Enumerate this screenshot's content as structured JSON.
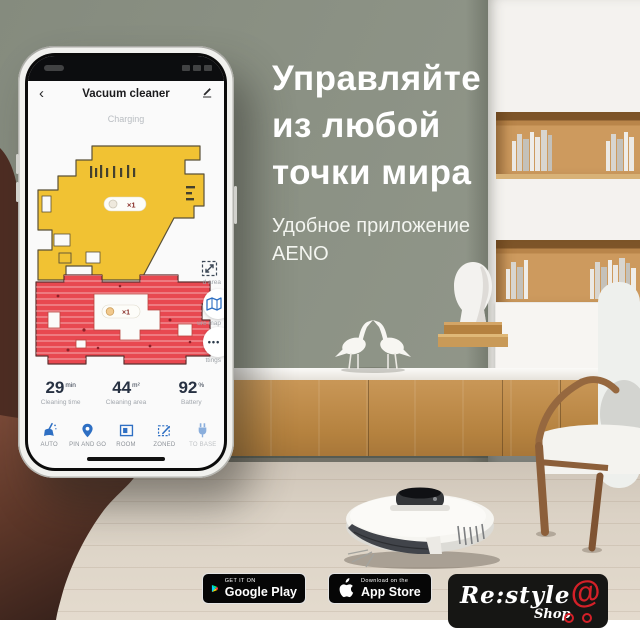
{
  "hero": {
    "title_line1": "Управляйте",
    "title_line2": "из любой",
    "title_line3": "точки мира",
    "subtitle": "Удобное приложение",
    "brand": "AENO"
  },
  "phone": {
    "back_glyph": "‹",
    "nav_title": "Vacuum cleaner",
    "status_text": "Charging",
    "map": {
      "upper_badge": "×1",
      "lower_badge": "×1",
      "side_labels": [
        "d area",
        "ure map",
        "ttings"
      ],
      "more_glyph": "•••"
    },
    "stats": [
      {
        "value": "29",
        "unit": "min",
        "label": "Cleaning time"
      },
      {
        "value": "44",
        "unit": "m²",
        "label": "Cleaning area"
      },
      {
        "value": "92",
        "unit": "%",
        "label": "Battery"
      }
    ],
    "toolbar": [
      {
        "label": "AUTO"
      },
      {
        "label": "PIN AND GO"
      },
      {
        "label": "ROOM"
      },
      {
        "label": "ZONED"
      },
      {
        "label": "TO BASE"
      }
    ]
  },
  "store_badges": {
    "google": {
      "tagline": "GET IT ON",
      "name": "Google Play"
    },
    "apple": {
      "tagline": "Download on the",
      "name": "App Store"
    }
  },
  "shop_logo": {
    "name": "Re:style",
    "sub": "Shop",
    "at": "@"
  },
  "colors": {
    "wall": "#8c9285",
    "floor": "#d9d0c4",
    "map_yellow": "#f1c233",
    "map_red": "#e84850",
    "accent_blue": "#2e6fc3",
    "badge_bg": "#060606",
    "logo_red": "#d42028"
  }
}
